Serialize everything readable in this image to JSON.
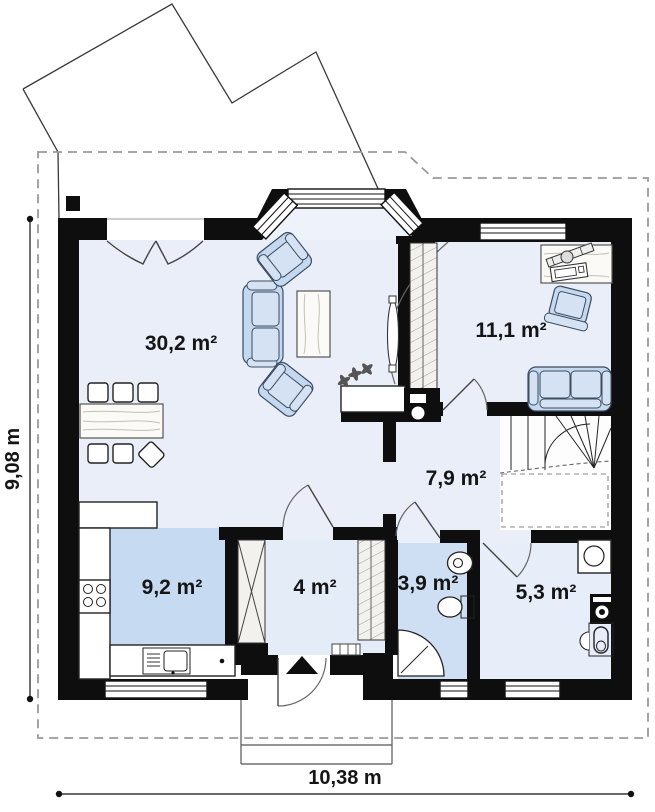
{
  "plan_title": "house-ground-floor-plan",
  "rooms": {
    "living": {
      "label": "30,2 m²"
    },
    "bedroom": {
      "label": "11,1 m²"
    },
    "hall": {
      "label": "7,9 m²"
    },
    "kitchen": {
      "label": "9,2 m²"
    },
    "vestibule": {
      "label": "4 m²"
    },
    "bathroom": {
      "label": "3,9 m²"
    },
    "utility": {
      "label": "5,3 m²"
    }
  },
  "dimensions": {
    "height": "9,08 m",
    "width": "10,38 m"
  },
  "colors": {
    "wall": "#0e0e0e",
    "floor_main": "#e9eef9",
    "floor_kitchen": "#c6dbf2",
    "floor_bathroom": "#cfdff3",
    "furniture_blue": "#c4d8ef"
  }
}
